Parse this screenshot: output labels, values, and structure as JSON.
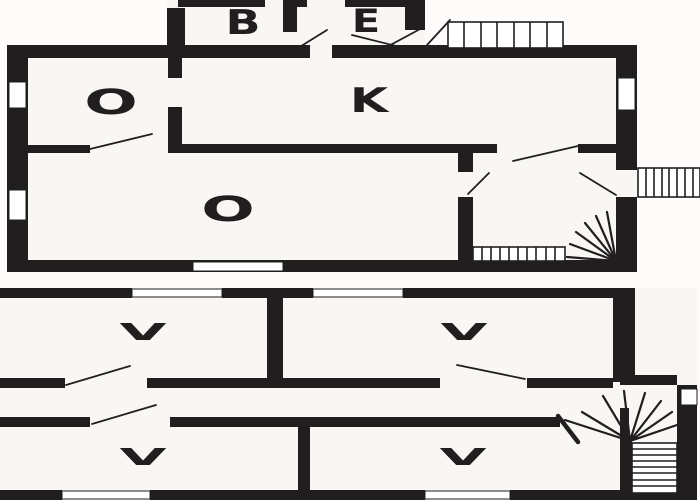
{
  "colors": {
    "wall": "#211e1f",
    "room": "#f8f7f4",
    "bg": "#fdfcfb",
    "window": "#ffffff"
  },
  "plan": {
    "upper_floor": {
      "rooms": [
        {
          "label": "B"
        },
        {
          "label": "E"
        },
        {
          "label": "O"
        },
        {
          "label": "K"
        },
        {
          "label": "O"
        }
      ]
    },
    "lower_floor": {
      "rooms": [
        {
          "label": "V"
        },
        {
          "label": "V"
        },
        {
          "label": "V"
        },
        {
          "label": "V"
        }
      ]
    }
  }
}
